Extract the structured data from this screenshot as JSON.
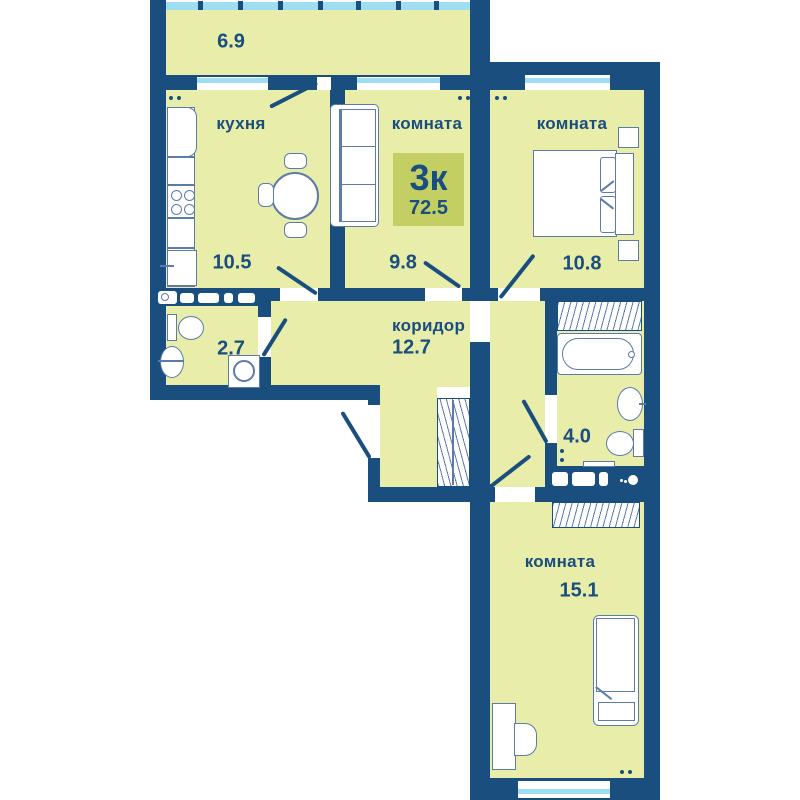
{
  "plan": {
    "badge": {
      "rooms_label": "3к",
      "total_area": "72.5"
    },
    "rooms": {
      "balcony": {
        "area": "6.9"
      },
      "kitchen": {
        "label": "кухня",
        "area": "10.5"
      },
      "living1": {
        "label": "комната",
        "area": "9.8"
      },
      "living2": {
        "label": "комната",
        "area": "10.8"
      },
      "corridor": {
        "label": "коридор",
        "area": "12.7"
      },
      "bathroom1": {
        "area": "2.7"
      },
      "bathroom2": {
        "area": "4.0"
      },
      "living3": {
        "label": "комната",
        "area": "15.1"
      }
    },
    "colors": {
      "wall": "#1A4E7E",
      "fill": "#E8EDA9",
      "badge": "#C3CF63",
      "glass": "#9FDDF3",
      "furniture": "#5C7BA8",
      "text": "#1A4E7E"
    }
  }
}
